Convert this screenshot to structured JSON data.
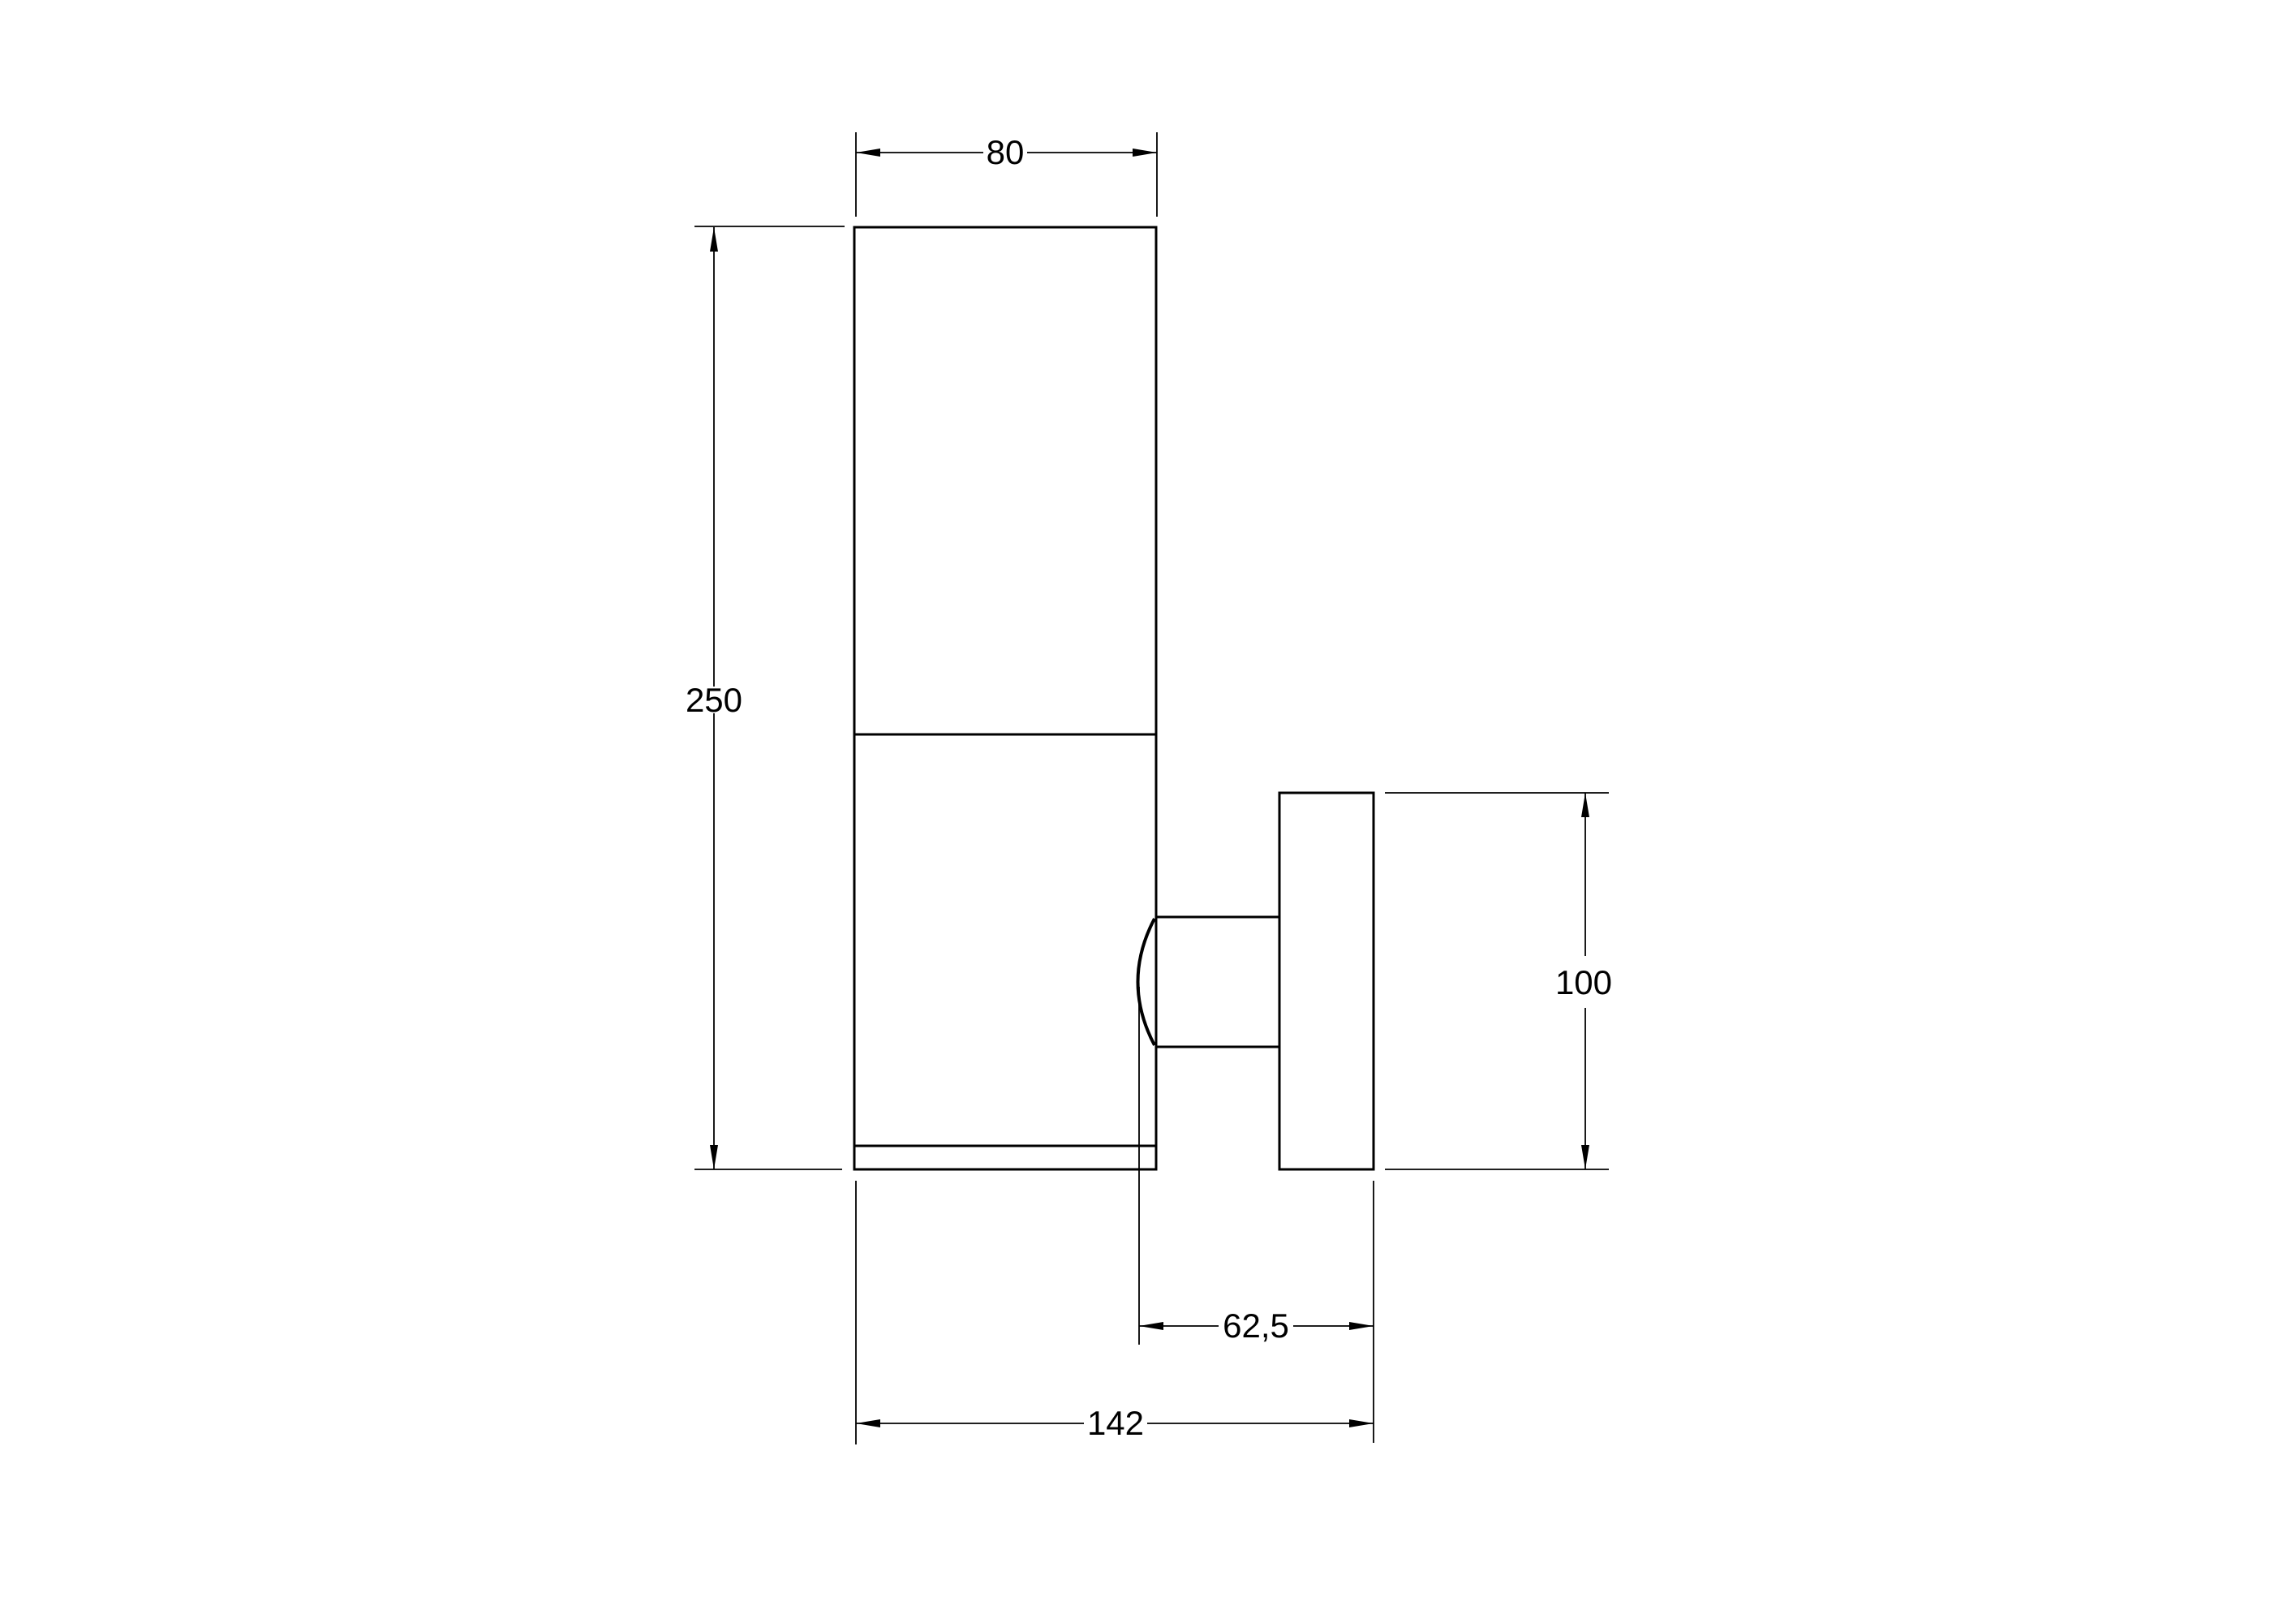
{
  "drawing": {
    "kind": "technical-dimension-drawing",
    "view": "side-elevation-wall-lamp",
    "background_color": "#ffffff",
    "line_color": "#000000",
    "dimensions": {
      "body_width": {
        "label": "80"
      },
      "body_height": {
        "label": "250"
      },
      "plate_height": {
        "label": "100"
      },
      "bracket_depth": {
        "label": "62,5"
      },
      "total_depth": {
        "label": "142"
      }
    }
  }
}
